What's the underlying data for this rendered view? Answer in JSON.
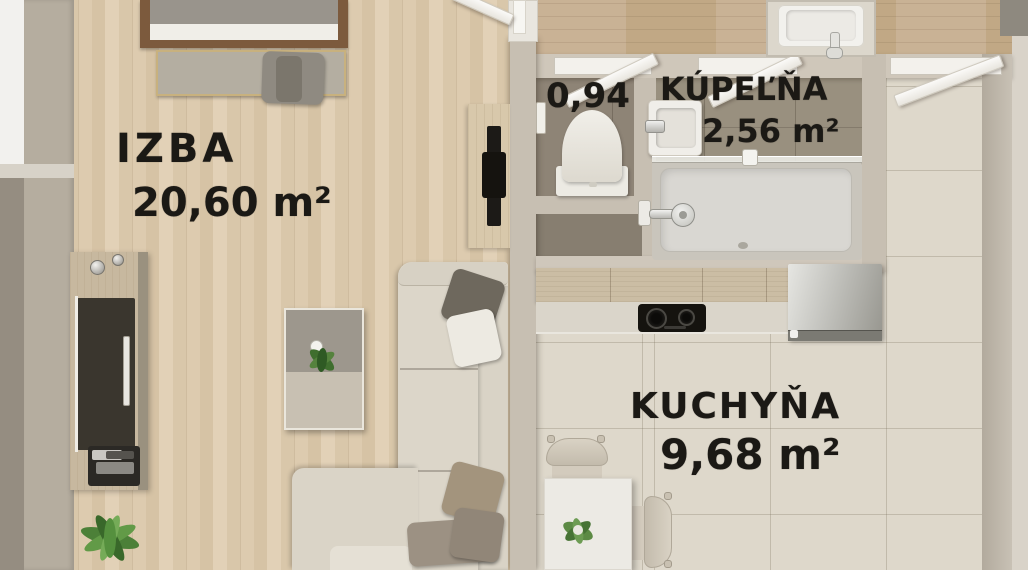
{
  "plan_title": "Apartment floor plan",
  "rooms": {
    "izba": {
      "name": "IZBA",
      "area": "20,60 m²"
    },
    "wc": {
      "area": "0,94"
    },
    "kupelna": {
      "name": "KÚPEĽŇA",
      "area": "2,56 m²"
    },
    "kuchyna": {
      "name": "KUCHYŇA",
      "area": "9,68 m²"
    }
  },
  "fixtures": {
    "izba": [
      "bed",
      "bench",
      "wardrobe",
      "tv-panel",
      "coffee-table",
      "corner-sofa",
      "plant"
    ],
    "wc": [
      "toilet"
    ],
    "kupelna": [
      "washbasin",
      "shower-tray",
      "shower-head",
      "glass-screen"
    ],
    "kuchyna": [
      "kitchen-counter",
      "cooktop",
      "fridge",
      "dining-table",
      "chair",
      "chair",
      "plant"
    ]
  },
  "palette": {
    "wood": "#d8c5a8",
    "woodDark": "#c4ac8e",
    "tile": "#ded8cb",
    "bathFloor": "#8e8476",
    "wall": "#c7bfb2",
    "sofa": "#dcd6c9",
    "glassDark": "#3a362e",
    "label": "#1b1915"
  }
}
